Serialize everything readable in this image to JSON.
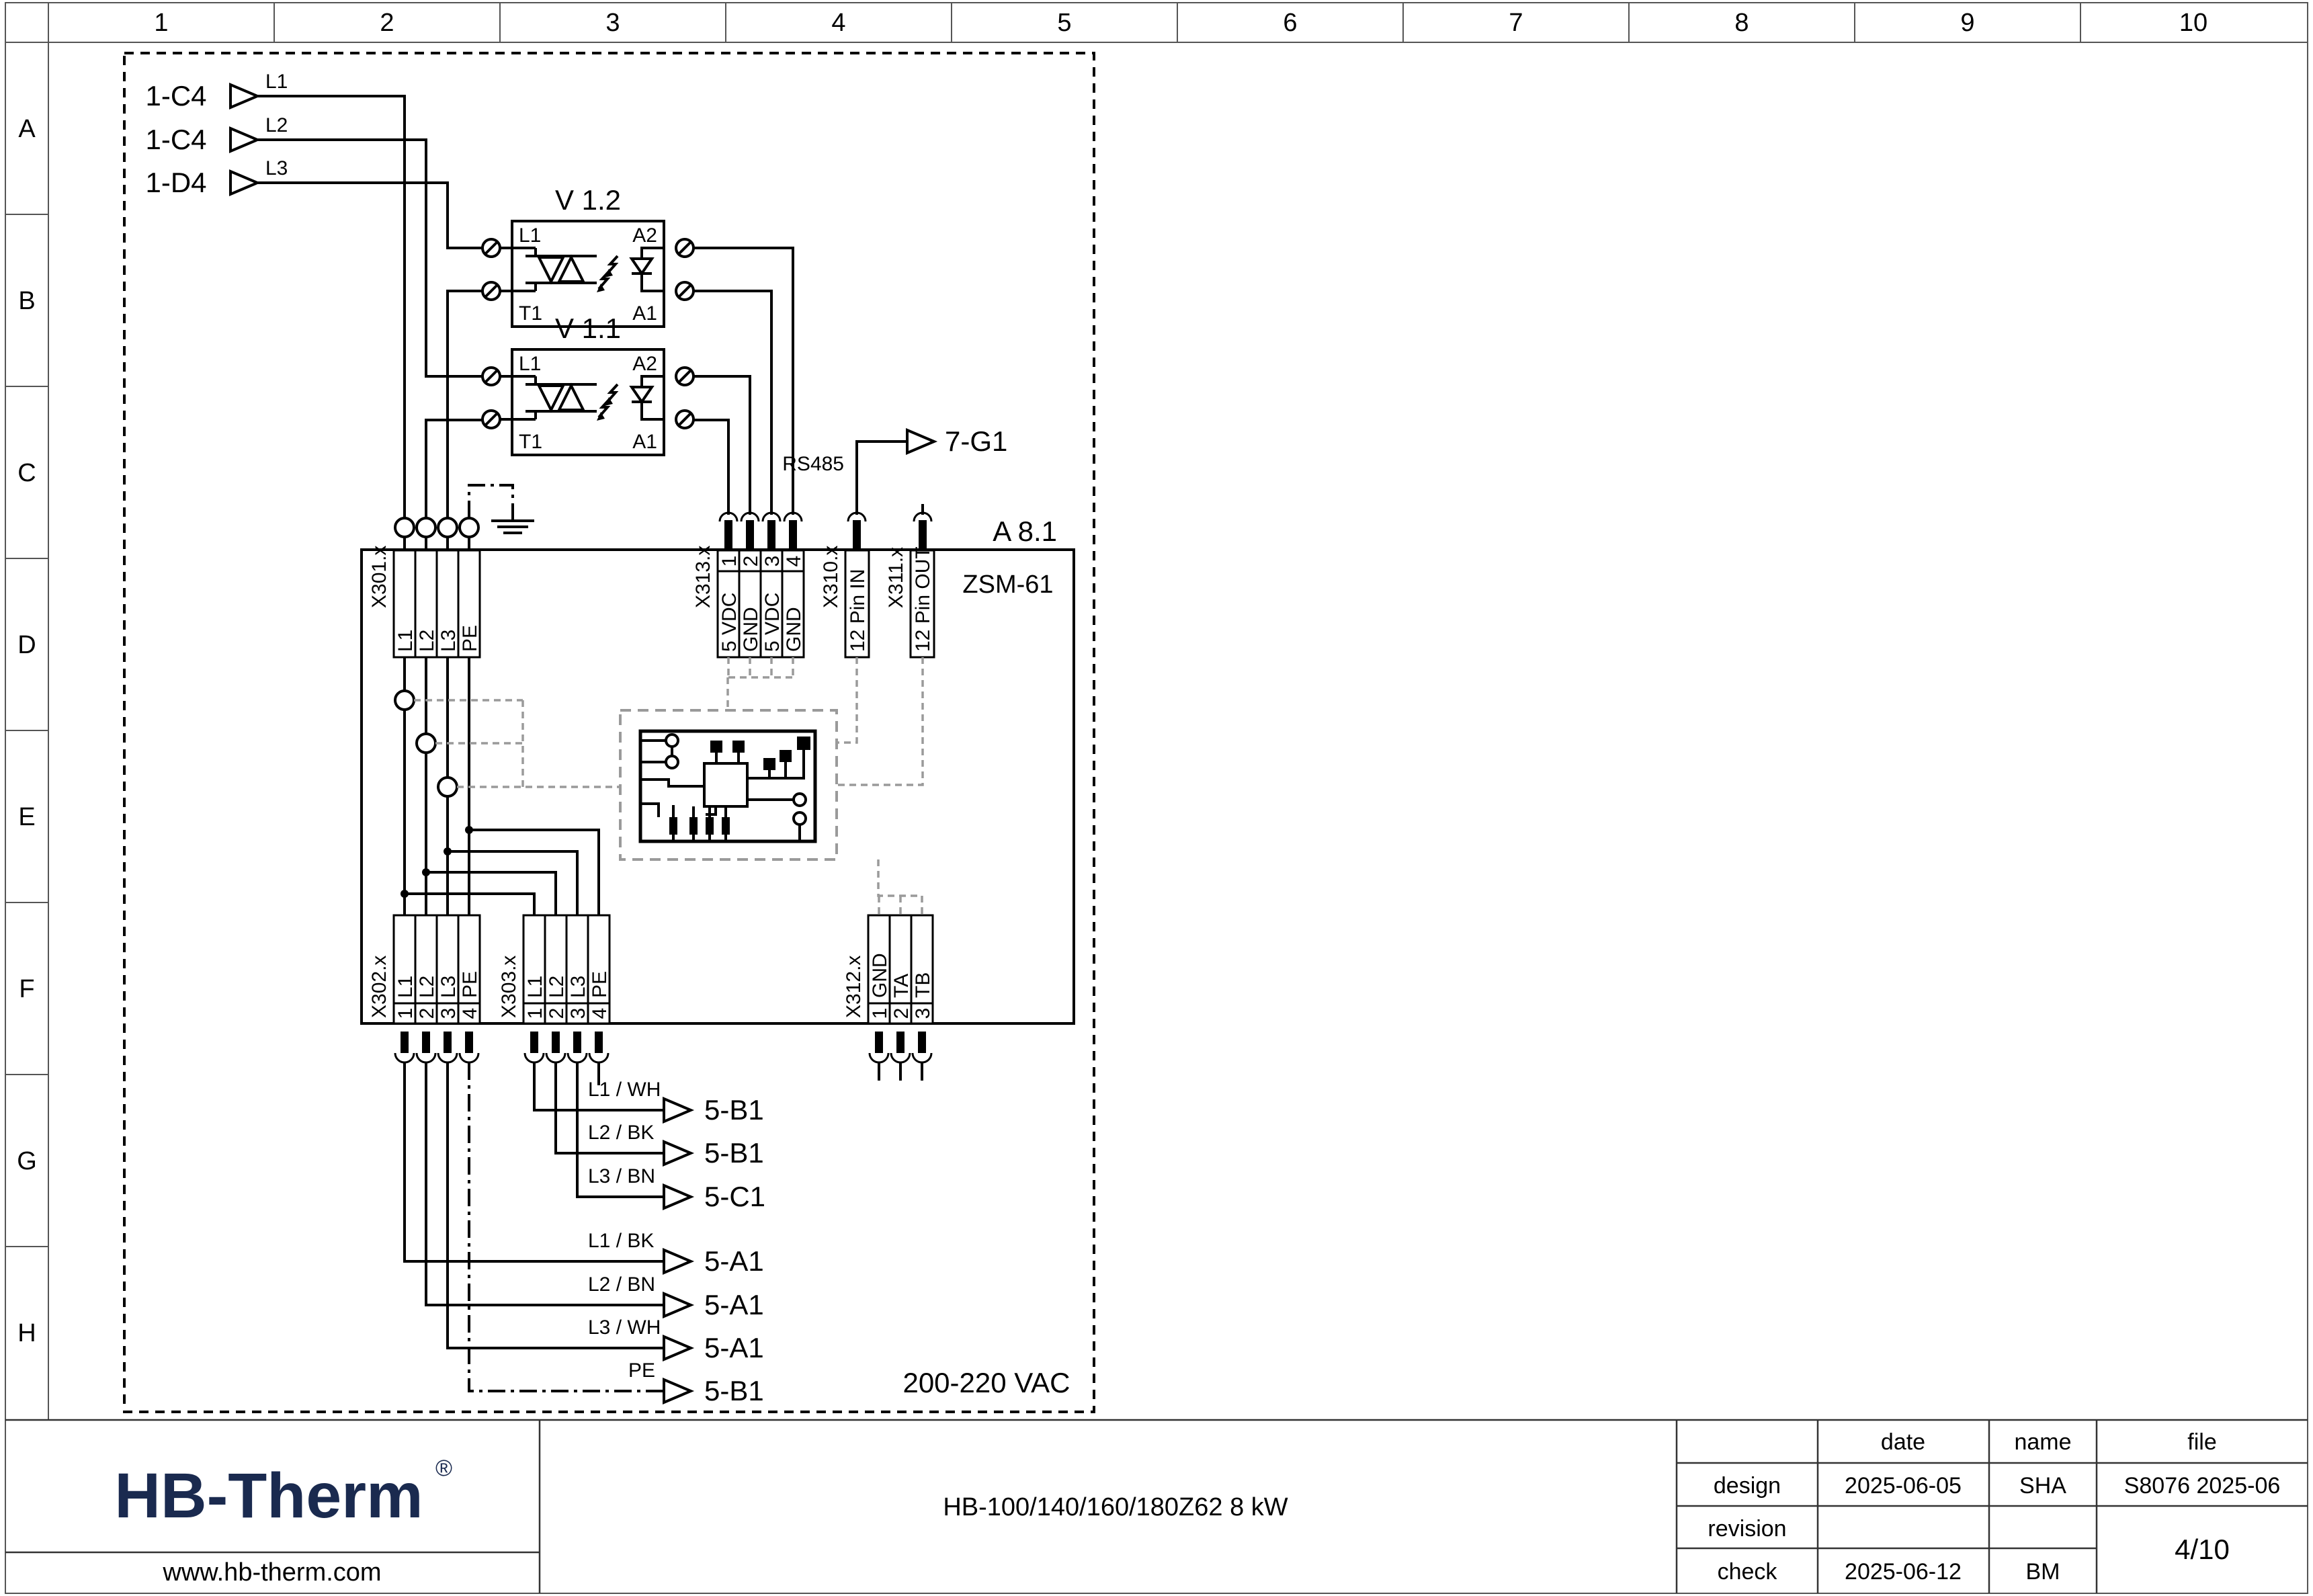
{
  "colors": {
    "accent_navy": "#1a2a4f",
    "dashed_gray": "#9a9a9a",
    "line": "#000000"
  },
  "grid": {
    "columns": [
      "1",
      "2",
      "3",
      "4",
      "5",
      "6",
      "7",
      "8",
      "9",
      "10"
    ],
    "rows": [
      "A",
      "B",
      "C",
      "D",
      "E",
      "F",
      "G",
      "H"
    ]
  },
  "sources": [
    {
      "tag": "1-C4",
      "phase": "L1"
    },
    {
      "tag": "1-C4",
      "phase": "L2"
    },
    {
      "tag": "1-D4",
      "phase": "L3"
    }
  ],
  "relays": [
    {
      "id": "V 1.2",
      "pin_tl": "L1",
      "pin_tr": "A2",
      "pin_bl": "T1",
      "pin_br": "A1"
    },
    {
      "id": "V 1.1",
      "pin_tl": "L1",
      "pin_tr": "A2",
      "pin_bl": "T1",
      "pin_br": "A1"
    }
  ],
  "comm": {
    "bus": "RS485",
    "target": "7-G1"
  },
  "module": {
    "ref": "A 8.1",
    "name": "ZSM-61"
  },
  "terminals": {
    "x301": {
      "id": "X301.x",
      "cells": [
        "L1",
        "L2",
        "L3",
        "PE"
      ]
    },
    "x313": {
      "id": "X313.x",
      "pins": [
        "1",
        "2",
        "3",
        "4"
      ],
      "cells": [
        "5 VDC",
        "GND",
        "5 VDC",
        "GND"
      ]
    },
    "x310": {
      "id": "X310.x",
      "label": "12 Pin IN"
    },
    "x311": {
      "id": "X311.x",
      "label": "12 Pin OUT"
    },
    "x302": {
      "id": "X302.x",
      "pins": [
        "1",
        "2",
        "3",
        "4"
      ],
      "cells": [
        "L1",
        "L2",
        "L3",
        "PE"
      ]
    },
    "x303": {
      "id": "X303.x",
      "pins": [
        "1",
        "2",
        "3",
        "4"
      ],
      "cells": [
        "L1",
        "L2",
        "L3",
        "PE"
      ]
    },
    "x312": {
      "id": "X312.x",
      "pins": [
        "1",
        "2",
        "3"
      ],
      "cells": [
        "GND",
        "TA",
        "TB"
      ]
    }
  },
  "outputs_upper": [
    {
      "wire": "L1 / WH",
      "target": "5-B1"
    },
    {
      "wire": "L2 / BK",
      "target": "5-B1"
    },
    {
      "wire": "L3 / BN",
      "target": "5-C1"
    }
  ],
  "outputs_lower": [
    {
      "wire": "L1 / BK",
      "target": "5-A1"
    },
    {
      "wire": "L2 / BN",
      "target": "5-A1"
    },
    {
      "wire": "L3 / WH",
      "target": "5-A1"
    },
    {
      "wire": "PE",
      "target": "5-B1"
    }
  ],
  "voltage_note": "200-220 VAC",
  "titleblock": {
    "logo_text": "HB-Therm",
    "logo_reg": "®",
    "website": "www.hb-therm.com",
    "doc_title": "HB-100/140/160/180Z62 8 kW",
    "col_date": "date",
    "col_name": "name",
    "col_file": "file",
    "rows": [
      {
        "label": "design",
        "date": "2025-06-05",
        "name": "SHA"
      },
      {
        "label": "revision",
        "date": "",
        "name": ""
      },
      {
        "label": "check",
        "date": "2025-06-12",
        "name": "BM"
      }
    ],
    "file_value": "S8076 2025-06",
    "page": "4/10"
  }
}
